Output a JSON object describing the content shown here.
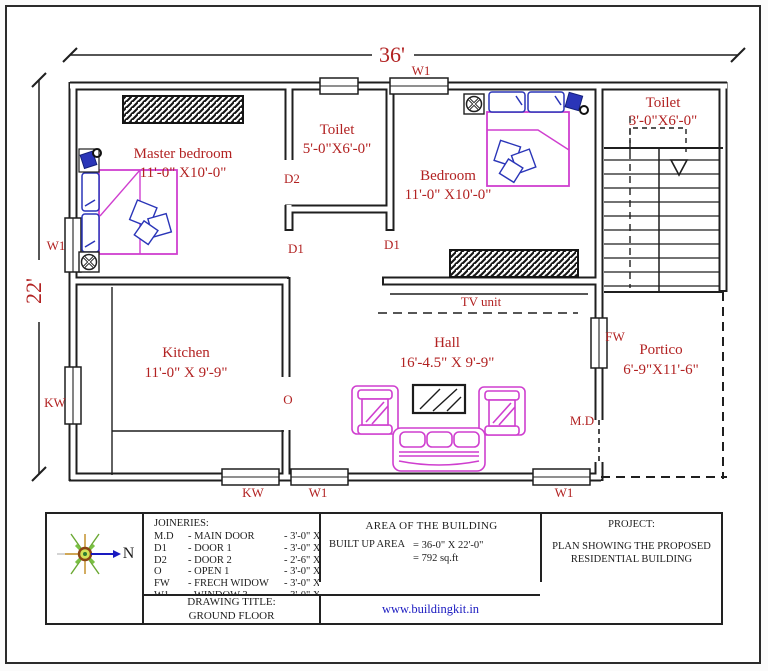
{
  "colors": {
    "line": "#1f1f1f",
    "label_red": "#b22222",
    "furniture_magenta": "#cf3fcf",
    "accessory_blue": "#2a35b8",
    "link_blue": "#1a1ac0"
  },
  "dimensions": {
    "overall_width": "36'",
    "overall_height": "22'"
  },
  "rooms": {
    "master_bedroom": {
      "name": "Master bedroom",
      "size": "11'-0\" X10'-0\""
    },
    "toilet1": {
      "name": "Toilet",
      "size": "5'-0\"X6'-0\""
    },
    "bedroom": {
      "name": "Bedroom",
      "size": "11'-0\" X10'-0\""
    },
    "toilet2": {
      "name": "Toilet",
      "size": "3'-0\"X6'-0\""
    },
    "kitchen": {
      "name": "Kitchen",
      "size": "11'-0\" X 9'-9\""
    },
    "hall": {
      "name": "Hall",
      "size": "16'-4.5\" X 9'-9\""
    },
    "portico": {
      "name": "Portico",
      "size": "6'-9\"X11'-6\""
    }
  },
  "plan_labels": {
    "w1_top": "W1",
    "w1_left": "W1",
    "kw_left": "KW",
    "kw_bottom": "KW",
    "w1_bottom_left": "W1",
    "w1_bottom_right": "W1",
    "d2": "D2",
    "d1_left": "D1",
    "d1_right": "D1",
    "o": "O",
    "fw": "FW",
    "md": "M.D",
    "tv_unit": "TV unit"
  },
  "title_block": {
    "north": "N",
    "area_heading": "AREA OF THE BUILDING",
    "builtup_label": "BUILT UP AREA",
    "builtup_value1": "= 36-0\" X 22'-0\"",
    "builtup_value2": "= 792 sq.ft",
    "drawing_title_label": "DRAWING TITLE:",
    "drawing_title_value": "GROUND FLOOR",
    "project_label": "PROJECT:",
    "project_name": "PLAN SHOWING THE PROPOSED RESIDENTIAL BUILDING",
    "website": "www.buildingkit.in"
  },
  "joineries": {
    "heading": "JOINERIES:",
    "rows": [
      {
        "abbr": "M.D",
        "name": "- MAIN DOOR",
        "size": "- 3'-0\" X 7'-0\""
      },
      {
        "abbr": "D1",
        "name": "- DOOR 1",
        "size": "- 3'-0\" X 7'-0\""
      },
      {
        "abbr": "D2",
        "name": "- DOOR 2",
        "size": "- 2'-6\" X 7'-0\""
      },
      {
        "abbr": "O",
        "name": "- OPEN 1",
        "size": "- 3'-0\" X 7'-0\""
      },
      {
        "abbr": "FW",
        "name": "- FRECH WIDOW",
        "size": "- 3'-0\" X 6'-0\""
      },
      {
        "abbr": "W1",
        "name": "- WINDOW 3",
        "size": "- 3'-0\" X 4'-0\""
      },
      {
        "abbr": "KW",
        "name": "- KITCHEN",
        "size": "- 3'-0\" X 3'-0\""
      },
      {
        "abbr": "V",
        "name": "- VENTILATOR",
        "size": "- 2'-0\" X 2'-0\""
      }
    ]
  }
}
